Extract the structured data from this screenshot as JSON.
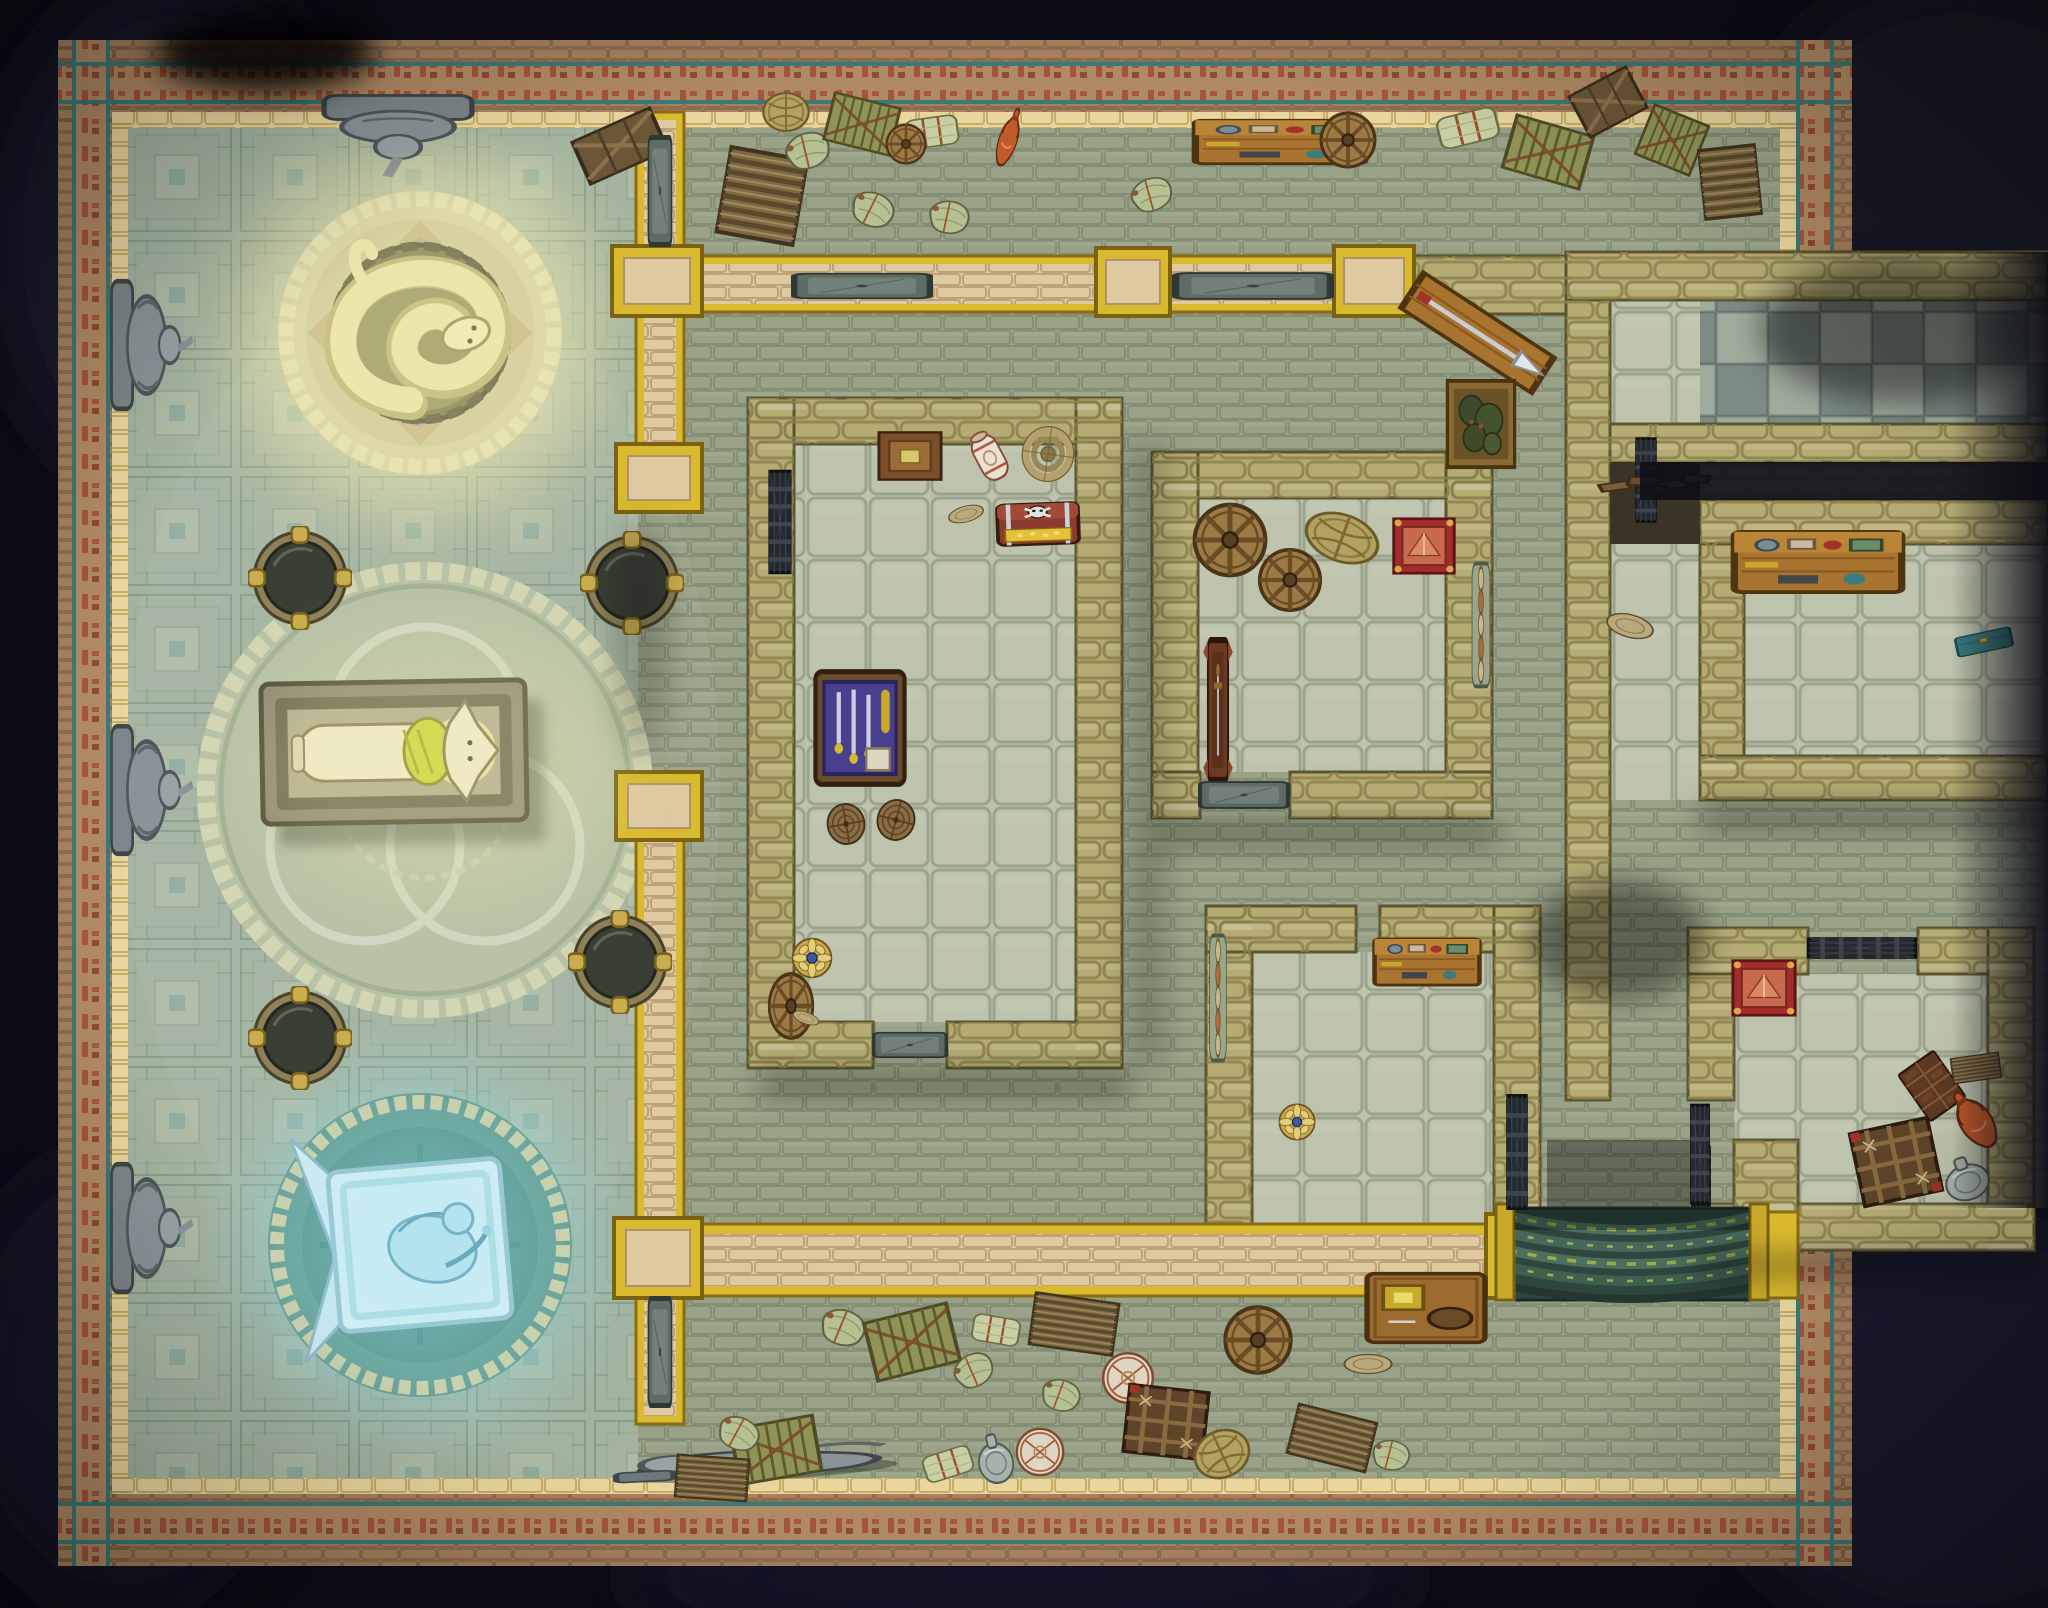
{
  "palette": {
    "bg": "#0d0d17",
    "bg_blotch": "#1d1d31",
    "border_brick": "#a7815f",
    "frieze_bg": "#b08a64",
    "frieze_red": "#a54a33",
    "teal_line": "#2e7b7d",
    "trim_gold": "#e9d69e",
    "temple_floor": "#a3b3a0",
    "corridor_floor": "#99a287",
    "room_floor": "#bdc3ac",
    "checker_light": "#9fab9d",
    "checker_dark": "#7c8b84",
    "wall_stone": "#b5ac74",
    "wall_tan": "#dec9a0",
    "accent_gold": "#d9b92e",
    "door_grey": "#5f6b66",
    "grate_iron": "#23282e",
    "glow_yellow": "#f2ecaf",
    "glow_blue": "#8fe0ef",
    "serpent_stone": "#e9e3ac",
    "mosaic_pale": "#d8d3a6",
    "mosaic_teal": "#6ba39a",
    "stairs_green": "#2e463e",
    "moss_green": "#a9b542"
  },
  "regions": [
    {
      "id": "temple-hall",
      "name": "temple hall with aztec patterned floor"
    },
    {
      "id": "serpent-shrine",
      "name": "glowing coiled serpent statue on round dais"
    },
    {
      "id": "burial-circle",
      "name": "knotwork mosaic circle with jackal sarcophagus"
    },
    {
      "id": "frost-shrine",
      "name": "blue glowing fallen angel plaque"
    },
    {
      "id": "storage-corridor-north",
      "name": "north storage corridor"
    },
    {
      "id": "storage-corridor-south",
      "name": "south storage corridor"
    },
    {
      "id": "treasury-room",
      "name": "large room with treasure chest and weapon case"
    },
    {
      "id": "wheel-room",
      "name": "room with cart wheels and red pedestal"
    },
    {
      "id": "pottery-room",
      "name": "room with broken red pots"
    },
    {
      "id": "checkered-hall",
      "name": "east wing checkered hall"
    },
    {
      "id": "workshop-room",
      "name": "east wing workshop room"
    },
    {
      "id": "relic-room",
      "name": "south-east relic room with red pedestal"
    },
    {
      "id": "stairway",
      "name": "mossy curved stair descending south"
    }
  ],
  "props": [
    {
      "name": "brazier-nw",
      "type": "brazier",
      "x": 300,
      "y": 578,
      "w": 104,
      "h": 104,
      "rot": 0,
      "interactable": true
    },
    {
      "name": "brazier-ne",
      "type": "brazier",
      "x": 632,
      "y": 583,
      "w": 104,
      "h": 104,
      "rot": 0,
      "interactable": true
    },
    {
      "name": "brazier-sw",
      "type": "brazier",
      "x": 300,
      "y": 1038,
      "w": 104,
      "h": 104,
      "rot": 0,
      "interactable": true
    },
    {
      "name": "brazier-se",
      "type": "brazier",
      "x": 620,
      "y": 962,
      "w": 104,
      "h": 104,
      "rot": 0,
      "interactable": true
    },
    {
      "name": "gargoyle-statue-top-wall",
      "type": "gargoyle",
      "x": 398,
      "y": 136,
      "w": 176,
      "h": 92,
      "rot": 0,
      "interactable": true
    },
    {
      "name": "gargoyle-statue-left-upper",
      "type": "gargoyle-side",
      "x": 152,
      "y": 345,
      "w": 88,
      "h": 152,
      "rot": 0,
      "interactable": true
    },
    {
      "name": "gargoyle-statue-left-middle",
      "type": "gargoyle-side",
      "x": 152,
      "y": 790,
      "w": 88,
      "h": 152,
      "rot": 0,
      "interactable": true
    },
    {
      "name": "gargoyle-statue-left-lower",
      "type": "gargoyle-side",
      "x": 152,
      "y": 1228,
      "w": 88,
      "h": 152,
      "rot": 0,
      "interactable": true
    },
    {
      "name": "fallen-statue",
      "type": "statue-fallen",
      "x": 756,
      "y": 1458,
      "w": 320,
      "h": 80,
      "rot": -3,
      "interactable": true
    },
    {
      "name": "crate-dark-1",
      "type": "crate",
      "x": 620,
      "y": 146,
      "w": 100,
      "h": 64,
      "rot": -24,
      "interactable": true
    },
    {
      "name": "crate-ridge-1",
      "type": "crate-ridge",
      "x": 762,
      "y": 196,
      "w": 88,
      "h": 102,
      "rot": 10,
      "interactable": true
    },
    {
      "name": "sack-1",
      "type": "sack",
      "x": 806,
      "y": 150,
      "w": 64,
      "h": 50,
      "rot": -18,
      "interactable": true
    },
    {
      "name": "basket-1",
      "type": "basket",
      "x": 786,
      "y": 112,
      "w": 54,
      "h": 54,
      "rot": 0,
      "interactable": true
    },
    {
      "name": "crate-slat-1",
      "type": "crate-slat",
      "x": 862,
      "y": 124,
      "w": 76,
      "h": 60,
      "rot": 14,
      "interactable": true
    },
    {
      "name": "bale-1",
      "type": "bale",
      "x": 932,
      "y": 132,
      "w": 64,
      "h": 48,
      "rot": -8,
      "interactable": true
    },
    {
      "name": "wheel-1",
      "type": "wheel",
      "x": 906,
      "y": 144,
      "w": 46,
      "h": 46,
      "rot": 0,
      "interactable": true
    },
    {
      "name": "sack-2",
      "type": "sack",
      "x": 872,
      "y": 208,
      "w": 62,
      "h": 48,
      "rot": 22,
      "interactable": true
    },
    {
      "name": "sack-3",
      "type": "sack",
      "x": 948,
      "y": 216,
      "w": 58,
      "h": 46,
      "rot": 8,
      "interactable": true
    },
    {
      "name": "amphora-red",
      "type": "amphora",
      "x": 1008,
      "y": 140,
      "w": 36,
      "h": 74,
      "rot": 18,
      "interactable": true
    },
    {
      "name": "workbench-north",
      "type": "bench-tools",
      "x": 1280,
      "y": 142,
      "w": 184,
      "h": 68,
      "rot": 0,
      "interactable": true
    },
    {
      "name": "tray-wheel",
      "type": "wheel",
      "x": 1348,
      "y": 140,
      "w": 64,
      "h": 64,
      "rot": 0,
      "interactable": true
    },
    {
      "name": "sack-4",
      "type": "sack",
      "x": 1150,
      "y": 194,
      "w": 60,
      "h": 46,
      "rot": -20,
      "interactable": true
    },
    {
      "name": "bale-2",
      "type": "bale",
      "x": 1468,
      "y": 128,
      "w": 74,
      "h": 52,
      "rot": -14,
      "interactable": true
    },
    {
      "name": "crate-slat-2",
      "type": "crate-slat",
      "x": 1548,
      "y": 152,
      "w": 90,
      "h": 68,
      "rot": 16,
      "interactable": true
    },
    {
      "name": "crate-dark-2",
      "type": "crate",
      "x": 1608,
      "y": 102,
      "w": 76,
      "h": 64,
      "rot": -28,
      "interactable": true
    },
    {
      "name": "crate-slat-3",
      "type": "crate-slat",
      "x": 1672,
      "y": 140,
      "w": 66,
      "h": 66,
      "rot": 22,
      "interactable": true
    },
    {
      "name": "crate-ridge-2",
      "type": "crate-ridge",
      "x": 1730,
      "y": 182,
      "w": 64,
      "h": 82,
      "rot": -6,
      "interactable": true
    },
    {
      "name": "counter-with-pike",
      "type": "counter-pike",
      "x": 1478,
      "y": 332,
      "w": 168,
      "h": 92,
      "rot": 33,
      "interactable": true
    },
    {
      "name": "moss-crate",
      "type": "plant-crate",
      "x": 1481,
      "y": 424,
      "w": 80,
      "h": 98,
      "rot": 0,
      "interactable": true
    },
    {
      "name": "picture-frame",
      "type": "frame",
      "x": 910,
      "y": 456,
      "w": 74,
      "h": 62,
      "rot": 0,
      "interactable": true
    },
    {
      "name": "ceramic-jar",
      "type": "jar",
      "x": 990,
      "y": 458,
      "w": 54,
      "h": 66,
      "rot": -28,
      "interactable": true
    },
    {
      "name": "serving-dish",
      "type": "plate",
      "x": 966,
      "y": 514,
      "w": 42,
      "h": 28,
      "rot": -15,
      "interactable": true
    },
    {
      "name": "rope-coil",
      "type": "rope",
      "x": 1048,
      "y": 454,
      "w": 64,
      "h": 68,
      "rot": 8,
      "interactable": true
    },
    {
      "name": "treasure-chest",
      "type": "chest-skull",
      "x": 1038,
      "y": 524,
      "w": 92,
      "h": 60,
      "rot": -2,
      "interactable": true
    },
    {
      "name": "weapon-case",
      "type": "case-weapons",
      "x": 860,
      "y": 728,
      "w": 106,
      "h": 128,
      "rot": 0,
      "interactable": true
    },
    {
      "name": "barrel-1",
      "type": "barrel",
      "x": 846,
      "y": 824,
      "w": 46,
      "h": 50,
      "rot": -10,
      "interactable": true
    },
    {
      "name": "barrel-2",
      "type": "barrel",
      "x": 896,
      "y": 820,
      "w": 46,
      "h": 50,
      "rot": 15,
      "interactable": true
    },
    {
      "name": "cart-wheel-1",
      "type": "wheel",
      "x": 791,
      "y": 1006,
      "w": 52,
      "h": 76,
      "rot": 0,
      "interactable": true
    },
    {
      "name": "rosette-shield",
      "type": "shield-rosette",
      "x": 812,
      "y": 958,
      "w": 46,
      "h": 46,
      "rot": 0,
      "interactable": true
    },
    {
      "name": "plate-1",
      "type": "plate",
      "x": 806,
      "y": 1018,
      "w": 32,
      "h": 20,
      "rot": 20,
      "interactable": true
    },
    {
      "name": "cart-wheel-2",
      "type": "wheel",
      "x": 1230,
      "y": 540,
      "w": 84,
      "h": 84,
      "rot": 0,
      "interactable": true
    },
    {
      "name": "cart-wheel-3",
      "type": "wheel",
      "x": 1290,
      "y": 580,
      "w": 72,
      "h": 72,
      "rot": 0,
      "interactable": true
    },
    {
      "name": "wicker-basket",
      "type": "basket",
      "x": 1342,
      "y": 538,
      "w": 88,
      "h": 66,
      "rot": 20,
      "interactable": true
    },
    {
      "name": "red-pedestal-1",
      "type": "pedestal-red",
      "x": 1424,
      "y": 546,
      "w": 72,
      "h": 68,
      "rot": 0,
      "interactable": true
    },
    {
      "name": "weapon-rack",
      "type": "rack",
      "x": 1218,
      "y": 710,
      "w": 46,
      "h": 152,
      "rot": 0,
      "interactable": true
    },
    {
      "name": "cup-tray-1",
      "type": "tray-cups",
      "x": 1481,
      "y": 625,
      "w": 28,
      "h": 128,
      "rot": 0,
      "interactable": true
    },
    {
      "name": "cup-tray-2",
      "type": "tray-cups",
      "x": 1218,
      "y": 998,
      "w": 26,
      "h": 130,
      "rot": 0,
      "interactable": true
    },
    {
      "name": "workbench-south",
      "type": "bench-tools",
      "x": 1427,
      "y": 962,
      "w": 114,
      "h": 72,
      "rot": 0,
      "interactable": true
    },
    {
      "name": "broken-pot-large",
      "type": "pot-red",
      "x": 1268,
      "y": 1160,
      "w": 92,
      "h": 112,
      "rot": -15,
      "interactable": true
    },
    {
      "name": "broken-pot-small",
      "type": "pot-red",
      "x": 1310,
      "y": 1186,
      "w": 54,
      "h": 58,
      "rot": 130,
      "interactable": true
    },
    {
      "name": "blue-disc",
      "type": "shield-rosette",
      "x": 1297,
      "y": 1122,
      "w": 42,
      "h": 42,
      "rot": 0,
      "interactable": true
    },
    {
      "name": "sack-5",
      "type": "sack",
      "x": 842,
      "y": 1326,
      "w": 64,
      "h": 50,
      "rot": 18,
      "interactable": true
    },
    {
      "name": "crate-slat-4",
      "type": "crate-slat",
      "x": 912,
      "y": 1342,
      "w": 96,
      "h": 74,
      "rot": -14,
      "interactable": true
    },
    {
      "name": "sack-6",
      "type": "sack",
      "x": 972,
      "y": 1370,
      "w": 58,
      "h": 46,
      "rot": -28,
      "interactable": true
    },
    {
      "name": "bale-3",
      "type": "bale",
      "x": 996,
      "y": 1330,
      "w": 58,
      "h": 44,
      "rot": 10,
      "interactable": true
    },
    {
      "name": "crate-ridge-3",
      "type": "crate-ridge",
      "x": 1074,
      "y": 1324,
      "w": 94,
      "h": 62,
      "rot": 8,
      "interactable": true
    },
    {
      "name": "drum-1",
      "type": "drum",
      "x": 1128,
      "y": 1378,
      "w": 62,
      "h": 62,
      "rot": 0,
      "interactable": true
    },
    {
      "name": "sack-7",
      "type": "sack",
      "x": 1060,
      "y": 1394,
      "w": 56,
      "h": 44,
      "rot": 16,
      "interactable": true
    },
    {
      "name": "net-crate",
      "type": "cage",
      "x": 1166,
      "y": 1422,
      "w": 94,
      "h": 80,
      "rot": 6,
      "interactable": true
    },
    {
      "name": "drum-2",
      "type": "drum",
      "x": 1040,
      "y": 1452,
      "w": 58,
      "h": 58,
      "rot": 0,
      "interactable": true
    },
    {
      "name": "silver-vase",
      "type": "jug",
      "x": 995,
      "y": 1458,
      "w": 50,
      "h": 66,
      "rot": -12,
      "interactable": true
    },
    {
      "name": "wheel-lid",
      "type": "wheel",
      "x": 1258,
      "y": 1340,
      "w": 78,
      "h": 78,
      "rot": 0,
      "interactable": true
    },
    {
      "name": "bowl-1",
      "type": "plate",
      "x": 1368,
      "y": 1364,
      "w": 56,
      "h": 34,
      "rot": 0,
      "interactable": true
    },
    {
      "name": "crate-slat-5",
      "type": "crate-slat",
      "x": 776,
      "y": 1450,
      "w": 94,
      "h": 70,
      "rot": -10,
      "interactable": true
    },
    {
      "name": "sack-8",
      "type": "sack",
      "x": 738,
      "y": 1432,
      "w": 60,
      "h": 46,
      "rot": 24,
      "interactable": true
    },
    {
      "name": "crate-ridge-4",
      "type": "crate-ridge",
      "x": 712,
      "y": 1478,
      "w": 80,
      "h": 50,
      "rot": 4,
      "interactable": true
    },
    {
      "name": "bale-4",
      "type": "bale",
      "x": 948,
      "y": 1464,
      "w": 60,
      "h": 44,
      "rot": -18,
      "interactable": true
    },
    {
      "name": "wicker-basket-2",
      "type": "basket",
      "x": 1222,
      "y": 1454,
      "w": 66,
      "h": 66,
      "rot": -25,
      "interactable": true
    },
    {
      "name": "crate-ridge-5",
      "type": "crate-ridge",
      "x": 1332,
      "y": 1438,
      "w": 90,
      "h": 60,
      "rot": 14,
      "interactable": true
    },
    {
      "name": "sack-9",
      "type": "sack",
      "x": 1390,
      "y": 1454,
      "w": 54,
      "h": 42,
      "rot": 10,
      "interactable": true
    },
    {
      "name": "side-table",
      "type": "table-gem",
      "x": 1426,
      "y": 1308,
      "w": 134,
      "h": 86,
      "rot": 0,
      "interactable": true
    },
    {
      "name": "workshop-bench",
      "type": "bench-tools",
      "x": 1818,
      "y": 562,
      "w": 182,
      "h": 94,
      "rot": 0,
      "interactable": true
    },
    {
      "name": "teal-chest",
      "type": "teal-box",
      "x": 1984,
      "y": 642,
      "w": 66,
      "h": 32,
      "rot": -12,
      "interactable": true
    },
    {
      "name": "mortar-bowl",
      "type": "plate",
      "x": 1630,
      "y": 626,
      "w": 56,
      "h": 40,
      "rot": 15,
      "interactable": true
    },
    {
      "name": "red-pedestal-2",
      "type": "pedestal-red",
      "x": 1764,
      "y": 988,
      "w": 74,
      "h": 68,
      "rot": 0,
      "interactable": true
    },
    {
      "name": "lattice-cage",
      "type": "cage",
      "x": 1896,
      "y": 1162,
      "w": 94,
      "h": 88,
      "rot": -12,
      "interactable": true
    },
    {
      "name": "grid-crate",
      "type": "choc",
      "x": 1932,
      "y": 1086,
      "w": 54,
      "h": 64,
      "rot": -35,
      "interactable": true
    },
    {
      "name": "barrel-side",
      "type": "crate-ridge",
      "x": 1976,
      "y": 1068,
      "w": 54,
      "h": 30,
      "rot": -8,
      "interactable": true
    },
    {
      "name": "orange-amphora",
      "type": "amphora",
      "x": 1976,
      "y": 1122,
      "w": 62,
      "h": 80,
      "rot": -35,
      "interactable": true
    },
    {
      "name": "grey-jug",
      "type": "jug",
      "x": 1966,
      "y": 1178,
      "w": 64,
      "h": 58,
      "rot": -20,
      "interactable": true
    },
    {
      "name": "door-temple-north",
      "type": "door",
      "x": 660,
      "y": 191,
      "w": 32,
      "h": 112,
      "rot": 0,
      "interactable": true
    },
    {
      "name": "door-temple-south",
      "type": "door",
      "x": 660,
      "y": 1352,
      "w": 32,
      "h": 112,
      "rot": 0,
      "interactable": true
    },
    {
      "name": "door-hall-west",
      "type": "door",
      "x": 862,
      "y": 286,
      "w": 34,
      "h": 142,
      "rot": 90,
      "interactable": true
    },
    {
      "name": "door-hall-east",
      "type": "door",
      "x": 1253,
      "y": 286,
      "w": 36,
      "h": 162,
      "rot": 90,
      "interactable": true
    },
    {
      "name": "door-room-a",
      "type": "door",
      "x": 910,
      "y": 1045,
      "w": 34,
      "h": 76,
      "rot": 90,
      "interactable": true
    },
    {
      "name": "door-room-b",
      "type": "door",
      "x": 1244,
      "y": 795,
      "w": 36,
      "h": 92,
      "rot": 90,
      "interactable": true
    },
    {
      "name": "grate-room-a",
      "type": "grate",
      "x": 780,
      "y": 522,
      "w": 28,
      "h": 110,
      "rot": 0,
      "interactable": true
    },
    {
      "name": "grate-room-c",
      "type": "grate",
      "x": 1517,
      "y": 1152,
      "w": 26,
      "h": 122,
      "rot": 0,
      "interactable": true
    },
    {
      "name": "grate-stairs-right",
      "type": "grate",
      "x": 1701,
      "y": 1176,
      "w": 24,
      "h": 64,
      "rot": 0,
      "interactable": true
    },
    {
      "name": "grate-relic-top",
      "type": "grate",
      "x": 1862,
      "y": 948,
      "w": 26,
      "h": 116,
      "rot": 90,
      "interactable": true
    },
    {
      "name": "grate-relic-left",
      "type": "grate",
      "x": 1700,
      "y": 1154,
      "w": 24,
      "h": 106,
      "rot": 0,
      "interactable": true
    },
    {
      "name": "grate-wing",
      "type": "grate",
      "x": 1646,
      "y": 480,
      "w": 26,
      "h": 90,
      "rot": 0,
      "interactable": true
    },
    {
      "name": "rubble-pile",
      "type": "rubble",
      "x": 1655,
      "y": 486,
      "w": 130,
      "h": 52,
      "rot": -3,
      "interactable": false
    }
  ]
}
